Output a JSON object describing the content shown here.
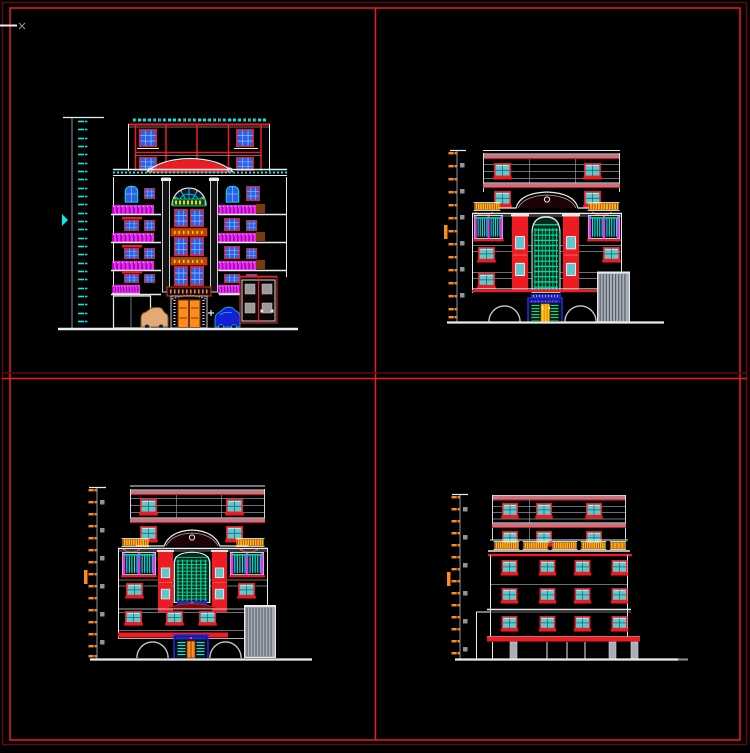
{
  "canvas": {
    "width": 750,
    "height": 753,
    "background": "#000000"
  },
  "palette": {
    "bg": "#000000",
    "red": "#ee1c22",
    "dark_red": "#5c0a18",
    "maroon": "#7e0808",
    "pink": "#c4737f",
    "cyan": "#00eeee",
    "green": "#00dd99",
    "yellow": "#f2d500",
    "orange": "#ff8c1a",
    "magenta": "#ee2bee",
    "blue": "#2e5fe8",
    "deep_blue": "#1c28c8",
    "tan": "#e2aa74",
    "white": "#ececec",
    "gray": "#8f959d",
    "glass": "#63c6cc",
    "shutter_gray": "#a8aeb8"
  },
  "sheet": {
    "frame": "double red border",
    "dividers": "red centerlines splitting sheet into four viewports"
  },
  "viewports": [
    {
      "id": "top-left",
      "drawing": "front elevation with roof frame, balconies and entrance"
    },
    {
      "id": "top-right",
      "drawing": "elevation with arched pediment, red piers and entry arches"
    },
    {
      "id": "bottom-left",
      "drawing": "elevation with arched pediment, red piers and entry arches"
    },
    {
      "id": "bottom-right",
      "drawing": "rear elevation with window grid and ground pilotis"
    }
  ]
}
